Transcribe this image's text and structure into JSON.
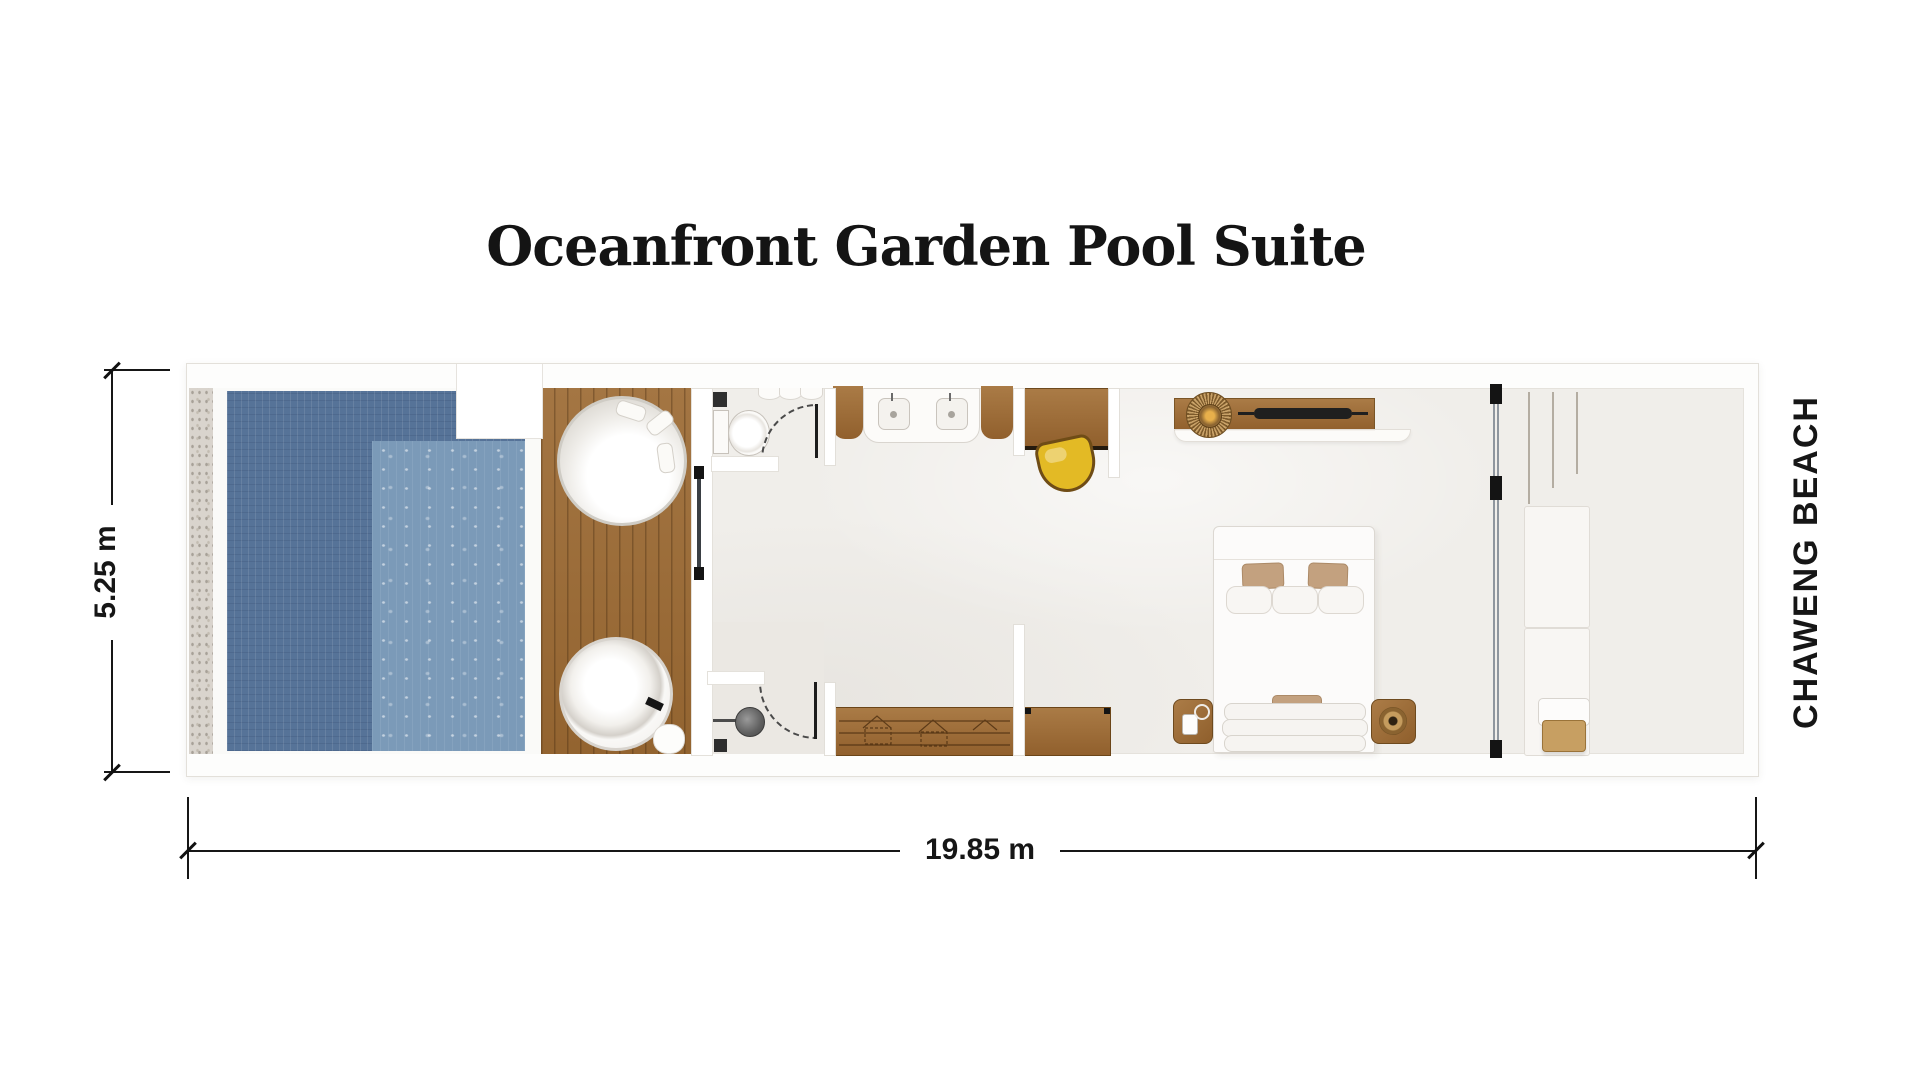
{
  "title": "Oceanfront Garden Pool Suite",
  "annotations": {
    "depth_dimension": "5.25 m",
    "width_dimension": "19.85 m",
    "beach_label": "CHAWENG BEACH"
  },
  "colors": {
    "pool_water": "#567398",
    "pool_sun_shelf": "#7b9ab8",
    "deck_wood": "#9c6a33",
    "furniture_wood": "#a4713a",
    "stool_accent": "#e3ba25",
    "floor": "#f0eeea",
    "wall": "#ffffff",
    "text": "#161616"
  },
  "features": [
    "plunge-pool",
    "pool-sun-shelf",
    "pebble-border",
    "timber-deck",
    "round-daybed",
    "round-bathtub",
    "bath-mat",
    "water-closet",
    "toilet",
    "rain-shower",
    "floor-drain",
    "double-vanity",
    "twin-sinks",
    "dressing-cabinet",
    "writing-desk",
    "stool",
    "tv-console",
    "sunburst-mirror",
    "television",
    "king-bed",
    "pillows",
    "nightstand-left",
    "nightstand-right",
    "sliding-glass-partition",
    "wardrobe-hanging-rail",
    "wardrobe-shelves",
    "luggage-bench",
    "entry-area",
    "dimension-lines"
  ]
}
